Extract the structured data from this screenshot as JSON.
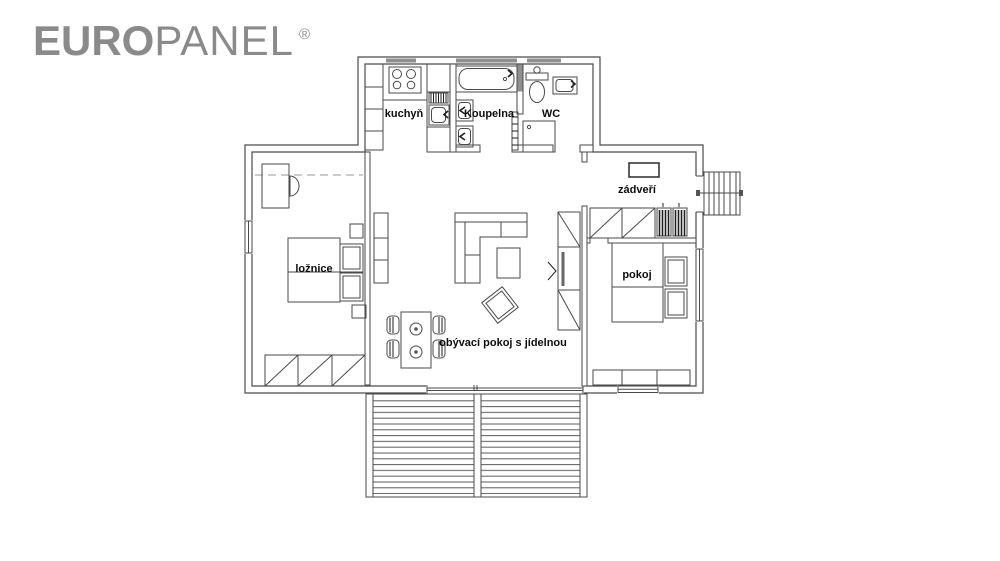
{
  "colors": {
    "background": "#ffffff",
    "logo_gray": "#8a8a8a",
    "line": "#4a4a4a",
    "line_dark": "#1f1f1f",
    "window_shade": "#8f8f8f"
  },
  "logo": {
    "bold_part": "EURO",
    "light_part": "PANEL",
    "registered_mark": "®"
  },
  "plan": {
    "rooms": [
      {
        "id": "kuchyn",
        "label": "kuchyň"
      },
      {
        "id": "koupelna",
        "label": "Koupelna"
      },
      {
        "id": "wc",
        "label": "WC"
      },
      {
        "id": "zadveri",
        "label": "zádveří"
      },
      {
        "id": "loznice",
        "label": "ložnice"
      },
      {
        "id": "pokoj",
        "label": "pokoj"
      },
      {
        "id": "obyvaci_pokoj",
        "label": "obývací pokoj s jídelnou"
      }
    ]
  }
}
